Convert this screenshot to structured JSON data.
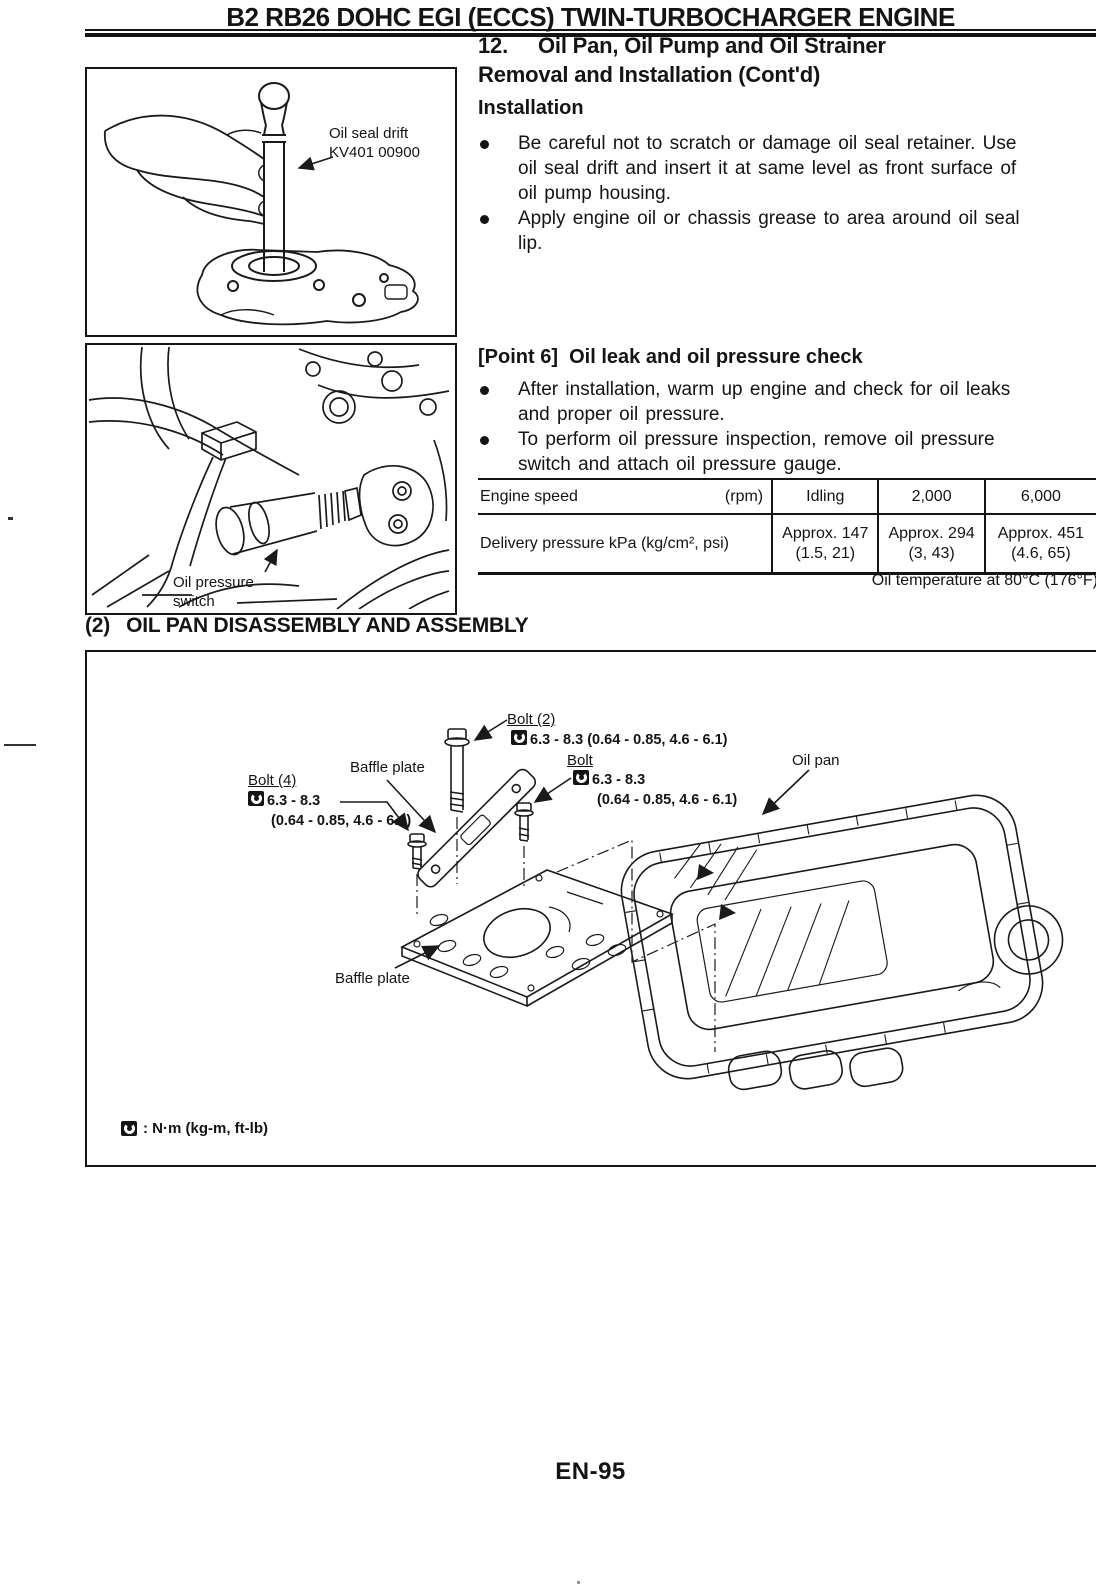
{
  "page": {
    "header_title": "B2 RB26 DOHC EGI (ECCS) TWIN-TURBOCHARGER ENGINE",
    "footer_page_number": "EN-95"
  },
  "section": {
    "number": "12.",
    "title_line1": "Oil Pan, Oil Pump and Oil Strainer",
    "title_line2": "Removal and Installation (Cont'd)",
    "installation": {
      "heading": "Installation",
      "bullet1_lines": [
        "Be careful not to scratch or damage oil seal retainer. Use",
        "oil seal drift and insert it at same level as front surface of",
        "oil pump housing."
      ],
      "bullet2_lines": [
        "Apply engine oil or chassis grease to area around oil seal",
        "lip."
      ]
    },
    "point6": {
      "label": "[Point 6]",
      "title": "Oil leak and oil pressure check",
      "bullet1_lines": [
        "After installation, warm up engine and check for oil leaks",
        "and proper oil pressure."
      ],
      "bullet2_lines": [
        "To perform oil pressure inspection, remove oil pressure",
        "switch and attach oil pressure gauge."
      ]
    }
  },
  "figures": {
    "oil_seal_drift": {
      "label_lines": [
        "Oil seal drift",
        "KV401 00900"
      ]
    },
    "oil_pressure_switch": {
      "label_lines": [
        "Oil pressure",
        "switch"
      ]
    }
  },
  "pressure_table": {
    "engine_speed_label": "Engine speed",
    "engine_speed_unit": "(rpm)",
    "speed_columns": [
      "Idling",
      "2,000",
      "6,000"
    ],
    "pressure_label": "Delivery pressure kPa (kg/cm², psi)",
    "values": [
      [
        "Approx. 147",
        "(1.5, 21)"
      ],
      [
        "Approx. 294",
        "(3, 43)"
      ],
      [
        "Approx. 451",
        "(4.6, 65)"
      ]
    ],
    "footnote": "Oil temperature at 80°C (176°F)"
  },
  "assembly": {
    "heading_prefix": "(2)",
    "heading_text": "OIL PAN DISASSEMBLY AND ASSEMBLY",
    "labels": {
      "bolt2_name": "Bolt (2)",
      "bolt2_torque": "6.3 - 8.3 (0.64 - 0.85, 4.6 - 6.1)",
      "bolt_name": "Bolt",
      "bolt_torque_line1": "6.3 - 8.3",
      "bolt_torque_lines": [
        "(0.64 - 0.85,",
        "4.6 - 6.1)"
      ],
      "bolt4_name": "Bolt (4)",
      "bolt4_torque_line1": "6.3 - 8.3",
      "bolt4_torque_lines": [
        "(0.64 - 0.85,",
        "4.6 - 6.1)"
      ],
      "baffle_plate_top": "Baffle plate",
      "baffle_plate_bottom": "Baffle plate",
      "oil_pan": "Oil pan"
    },
    "legend_text": ": N·m (kg-m, ft-lb)"
  }
}
